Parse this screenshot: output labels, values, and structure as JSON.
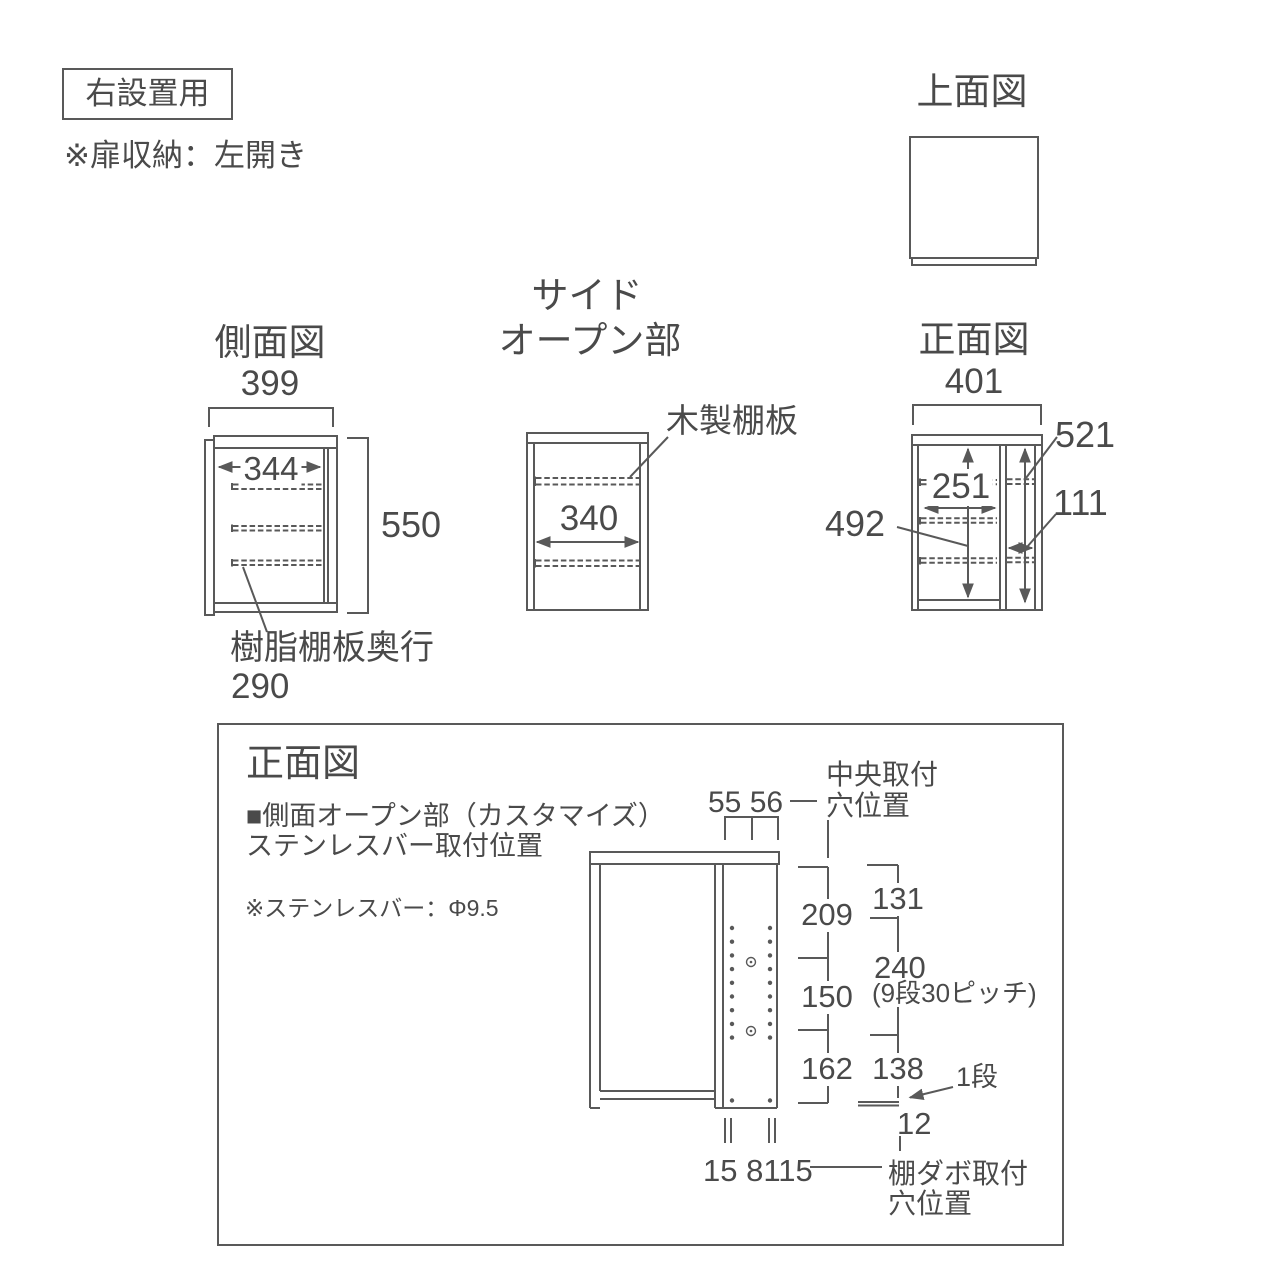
{
  "colors": {
    "line": "#595959",
    "text": "#4a4a4a",
    "background": "#ffffff"
  },
  "header": {
    "usage_label": "右設置用",
    "door_note": "※扉収納：左開き"
  },
  "top_view": {
    "title": "上面図"
  },
  "side_view": {
    "title": "側面図",
    "outer_depth": "399",
    "inner_depth": "344",
    "height": "550",
    "shelf_label": "樹脂棚板奥行",
    "shelf_depth": "290"
  },
  "side_open": {
    "title_line1": "サイド",
    "title_line2": "オープン部",
    "shelf_label": "木製棚板",
    "inner_width": "340"
  },
  "front_view": {
    "title": "正面図",
    "outer_width": "401",
    "inner_width": "251",
    "inner_height": "492",
    "side_height": "521",
    "side_width": "111"
  },
  "detail_panel": {
    "title": "正面図",
    "subtitle_line1": "■側面オープン部（カスタマイズ）",
    "subtitle_line2": "ステンレスバー取付位置",
    "note": "※ステンレスバー：Φ9.5",
    "dim_top": "55 56",
    "center_hole_label_line1": "中央取付",
    "center_hole_label_line2": "穴位置",
    "dims_left": [
      "209",
      "150",
      "162"
    ],
    "dim_131": "131",
    "dim_240": "240",
    "dim_240_note": "(9段30ピッチ)",
    "dim_138": "138",
    "step_label": "1段",
    "dim_12": "12",
    "dim_bottom": "15 8115",
    "shelf_pin_label_line1": "棚ダボ取付",
    "shelf_pin_label_line2": "穴位置"
  }
}
